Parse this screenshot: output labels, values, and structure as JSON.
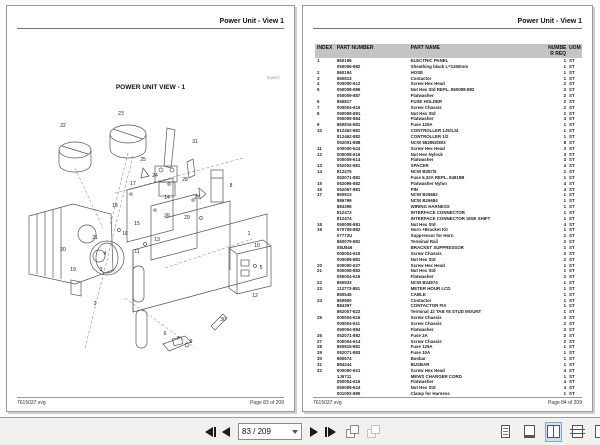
{
  "left_page": {
    "header_title": "Power Unit - View 1",
    "diagram_title": "POWER UNIT VIEW - 1",
    "drawing_number": "7615037",
    "footer_left": "7615037.svg",
    "footer_right": "Page 83 of 209"
  },
  "right_page": {
    "header_title": "Power Unit - View 1",
    "footer_left": "7615037.svg",
    "footer_right": "Page 84 of 209"
  },
  "table": {
    "headers": {
      "index": "INDEX",
      "part_number": "PART NUMBER",
      "part_name": "PART NAME",
      "qty_line1": "NUMBE",
      "qty_line2": "R REQ",
      "uom": "UOM"
    },
    "rows": [
      [
        "1",
        "860196",
        "ELECTRIC PANEL",
        "1",
        "ST"
      ],
      [
        "",
        "050055-882",
        "Sheathing black L=1150mm",
        "1",
        "ST"
      ],
      [
        "2",
        "860194",
        "HOSE",
        "1",
        "ST"
      ],
      [
        "3",
        "860813",
        "Contactor",
        "1",
        "ST"
      ],
      [
        "4",
        "000000-612",
        "Screw Hex Head",
        "2",
        "ST"
      ],
      [
        "5",
        "050008-886",
        "Nut Hex Std REPL. 860088-882",
        "2",
        "ST"
      ],
      [
        "",
        "050009-887",
        "Flatwasher",
        "2",
        "ST"
      ],
      [
        "6",
        "860817",
        "FUSE HOLDER",
        "2",
        "ST"
      ],
      [
        "7",
        "000004-616",
        "Screw Chassis",
        "2",
        "ST"
      ],
      [
        "8",
        "050008-881",
        "Nut Hex Std",
        "2",
        "ST"
      ],
      [
        "",
        "050009-884",
        "Flatwasher",
        "4",
        "ST"
      ],
      [
        "9",
        "860816-881",
        "Fuse 125A",
        "1",
        "ST"
      ],
      [
        "10",
        "812462-881",
        "CONTROLLER 1J5/1J4",
        "1",
        "ST"
      ],
      [
        "",
        "812462-882",
        "CONTROLLER 1/2",
        "1",
        "ST"
      ],
      [
        "",
        "052001-888",
        "NCW 862892/803",
        "8",
        "ST"
      ],
      [
        "11",
        "000000-624",
        "Screw Hex Head",
        "3",
        "ST"
      ],
      [
        "12",
        "000008-616",
        "Nut Hex Nylock",
        "3",
        "ST"
      ],
      [
        "",
        "000009-614",
        "Flatwasher",
        "3",
        "ST"
      ],
      [
        "13",
        "052002-881",
        "SPACER",
        "4",
        "ST"
      ],
      [
        "14",
        "812475",
        "NCW B287/5",
        "1",
        "ST"
      ],
      [
        "",
        "052071-881",
        "Fuse  6,32A  REPL. 84919B",
        "1",
        "ST"
      ],
      [
        "15",
        "052096-882",
        "Flatwasher Nylon",
        "4",
        "ST"
      ],
      [
        "16",
        "052067-881",
        "PIN",
        "4",
        "ST"
      ],
      [
        "17",
        "860913",
        "NCW B26682",
        "1",
        "ST"
      ],
      [
        "",
        "886799",
        "NCW B26684",
        "1",
        "ST"
      ],
      [
        "",
        "884398",
        "WIRING HARNESS",
        "1",
        "ST"
      ],
      [
        "",
        "812473",
        "INTERFACE CONNECTOR",
        "1",
        "ST"
      ],
      [
        "",
        "812474",
        "INTERFACE CONNECTOR SIDE SHIFT",
        "1",
        "ST"
      ],
      [
        "18",
        "050008-881",
        "Nut Hex Std",
        "4",
        "ST"
      ],
      [
        "19",
        "070709-882",
        "Horn +Bracket Kit",
        "1",
        "ST"
      ],
      [
        "",
        "07772U",
        "Suppressor for Horn",
        "1",
        "ST"
      ],
      [
        "",
        "860079-881",
        "Terminal Rail",
        "2",
        "ST"
      ],
      [
        "",
        "08U546",
        "BRACKET SUPPRESSOR",
        "1",
        "ST"
      ],
      [
        "",
        "000004-615",
        "Screw Chassis",
        "2",
        "ST"
      ],
      [
        "",
        "000008-881",
        "Nut Hex Std",
        "2",
        "ST"
      ],
      [
        "20",
        "000000-627",
        "Screw Hex Head",
        "1",
        "ST"
      ],
      [
        "21",
        "050008-882",
        "Nut Hex Std",
        "1",
        "ST"
      ],
      [
        "",
        "050004-616",
        "Flatwasher",
        "2",
        "ST"
      ],
      [
        "22",
        "860933",
        "NCW B24974",
        "1",
        "ST"
      ],
      [
        "23",
        "112773-881",
        "METER HOUR LCD",
        "1",
        "ST"
      ],
      [
        "",
        "860545",
        "CABLE",
        "1",
        "ST"
      ],
      [
        "24",
        "860800",
        "Contactor",
        "1",
        "ST"
      ],
      [
        "",
        "884397",
        "CONTACTOR FIX",
        "1",
        "ST"
      ],
      [
        "",
        "862007-822",
        "Terminal J2 TAB #8 STUD MOUNT",
        "1",
        "ST"
      ],
      [
        "25",
        "000004-616",
        "Screw Chassis",
        "2",
        "ST"
      ],
      [
        "",
        "000004-611",
        "Screw Chassis",
        "2",
        "ST"
      ],
      [
        "",
        "050004-884",
        "Flatwasher",
        "2",
        "ST"
      ],
      [
        "26",
        "052071-882",
        "Fuse  2A",
        "2",
        "ST"
      ],
      [
        "27",
        "000004-614",
        "Screw Chassis",
        "2",
        "ST"
      ],
      [
        "28",
        "860815-881",
        "Fuse 125A",
        "1",
        "ST"
      ],
      [
        "29",
        "052071-883",
        "Fuse 10A",
        "1",
        "ST"
      ],
      [
        "30",
        "860674",
        "Busbar",
        "1",
        "ST"
      ],
      [
        "31",
        "884244",
        "BUSBAR",
        "1",
        "ST"
      ],
      [
        "32",
        "000000-621",
        "Screw Hex Head",
        "4",
        "ST"
      ],
      [
        "",
        "1J6711",
        "MEWS CHARGER CORD",
        "1",
        "ST"
      ],
      [
        "",
        "050004-616",
        "Flatwasher",
        "4",
        "ST"
      ],
      [
        "",
        "050008-624",
        "Nut Hex Std",
        "4",
        "ST"
      ],
      [
        "",
        "001002-885",
        "Clamp for Harness",
        "1",
        "ST"
      ]
    ]
  },
  "diagram": {
    "callouts": [
      {
        "label": "22",
        "x": 48,
        "y": 28
      },
      {
        "label": "23",
        "x": 106,
        "y": 16
      },
      {
        "label": "31",
        "x": 180,
        "y": 44
      },
      {
        "label": "25",
        "x": 128,
        "y": 62
      },
      {
        "label": "24",
        "x": 140,
        "y": 78
      },
      {
        "label": "17",
        "x": 118,
        "y": 86
      },
      {
        "label": "28",
        "x": 170,
        "y": 82
      },
      {
        "label": "8",
        "x": 216,
        "y": 88
      },
      {
        "label": "14",
        "x": 152,
        "y": 100
      },
      {
        "label": "18",
        "x": 100,
        "y": 108
      },
      {
        "label": "27",
        "x": 182,
        "y": 100
      },
      {
        "label": "26",
        "x": 152,
        "y": 118
      },
      {
        "label": "29",
        "x": 172,
        "y": 120
      },
      {
        "label": "15",
        "x": 122,
        "y": 126
      },
      {
        "label": "16",
        "x": 110,
        "y": 136
      },
      {
        "label": "1",
        "x": 234,
        "y": 136
      },
      {
        "label": "21",
        "x": 80,
        "y": 140
      },
      {
        "label": "13",
        "x": 142,
        "y": 142
      },
      {
        "label": "11",
        "x": 122,
        "y": 154
      },
      {
        "label": "20",
        "x": 48,
        "y": 152
      },
      {
        "label": "4",
        "x": 90,
        "y": 156
      },
      {
        "label": "3",
        "x": 86,
        "y": 172
      },
      {
        "label": "19",
        "x": 58,
        "y": 172
      },
      {
        "label": "10",
        "x": 242,
        "y": 148
      },
      {
        "label": "5",
        "x": 246,
        "y": 170
      },
      {
        "label": "12",
        "x": 240,
        "y": 198
      },
      {
        "label": "2",
        "x": 80,
        "y": 206
      },
      {
        "label": "30",
        "x": 208,
        "y": 222
      },
      {
        "label": "6",
        "x": 150,
        "y": 236
      },
      {
        "label": "7",
        "x": 163,
        "y": 241
      },
      {
        "label": "9",
        "x": 176,
        "y": 244
      }
    ]
  },
  "toolbar": {
    "page_input": "83 / 209",
    "icons": {
      "first_page": "first-page-icon",
      "prev_page": "previous-page-icon",
      "next_page": "next-page-icon",
      "last_page": "last-page-icon",
      "prev_view": "previous-view-icon",
      "next_view": "next-view-icon",
      "single_page_view": "single-page-view-icon",
      "fit_page_view": "fit-page-view-icon",
      "facing_pages_view": "facing-pages-view-icon",
      "continuous_view": "continuous-view-icon"
    },
    "active_view": "facing-pages-view",
    "colors": {
      "active_icon_bg": "#cfe0f3",
      "active_icon_border": "#7da7d9",
      "table_header_bg": "#c4c4c4"
    }
  }
}
